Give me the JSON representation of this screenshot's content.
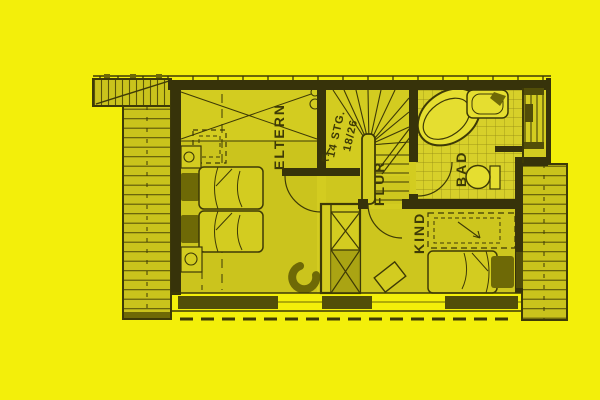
{
  "document": {
    "kind": "scanned architectural floor plan, upper storey"
  },
  "plan": {
    "rooms": [
      {
        "id": "eltern",
        "label": "ELTERN"
      },
      {
        "id": "flur",
        "label": "FLUR"
      },
      {
        "id": "bad",
        "label": "BAD"
      },
      {
        "id": "kind",
        "label": "KIND"
      }
    ],
    "stairs": {
      "count_label": "14 STG.",
      "dimension_label": "18/26"
    }
  },
  "colors": {
    "page_background": "#f3ef0a",
    "paper": "#d3cc20",
    "paper_shade": "#a49d10",
    "line_dark": "#3e3a06",
    "wall_dark": "#37330a",
    "fill_dark": "#6e6906",
    "window_bar": "#524e08",
    "hatch_fill": "#cac31c",
    "hatch_line": "#5a5408",
    "tile_area": "#d7d02a",
    "tile_line": "#8e8812",
    "fixture_fill": "#e5de30",
    "chimney_cell": "#a29c12"
  }
}
